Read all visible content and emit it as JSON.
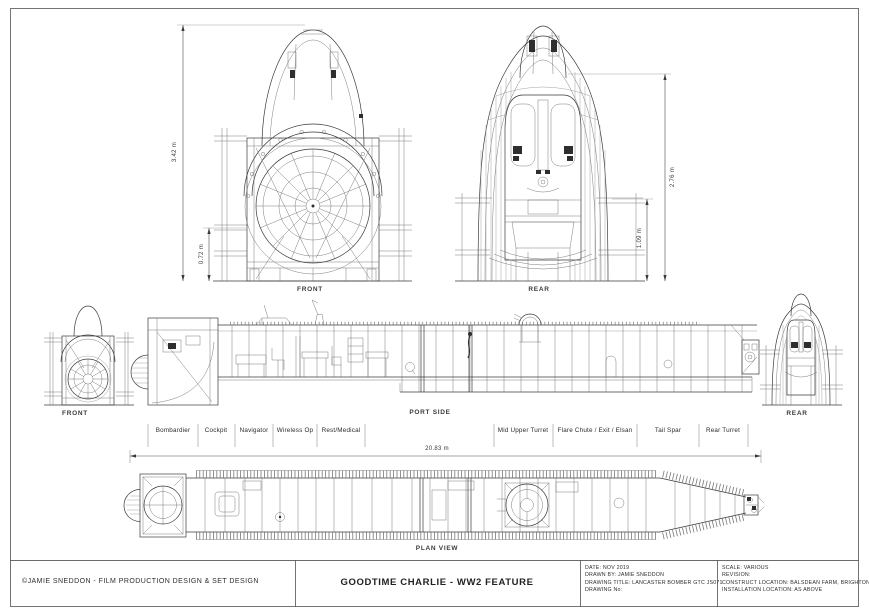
{
  "views": {
    "front_section_label": "FRONT",
    "rear_section_label": "REAR",
    "front_small_label": "FRONT",
    "port_side_label": "PORT SIDE",
    "rear_small_label": "REAR",
    "plan_label": "PLAN VIEW"
  },
  "dimensions": {
    "front_total_height": "3.42 m",
    "front_floor_height": "0.72 m",
    "rear_total_height": "2.76 m",
    "rear_floor_height": "1.09 m",
    "fuselage_length": "20.83 m"
  },
  "compartments": [
    "Bombardier",
    "Cockpit",
    "Navigator",
    "Wireless Op",
    "Rest/Medical",
    "Mid Upper Turret",
    "Flare Chute / Exit / Elsan",
    "Tail Spar",
    "Rear Turret"
  ],
  "title_block": {
    "copyright": "©JAMIE SNEDDON - FILM PRODUCTION DESIGN & SET DESIGN",
    "project_title": "GOODTIME CHARLIE - WW2 FEATURE",
    "info_left": [
      "DATE: NOV 2019",
      "DRAWN BY: JAMIE SNEDDON",
      "DRAWING TITLE: LANCASTER BOMBER GTC JS071",
      "DRAWING No:"
    ],
    "info_right": [
      "SCALE: VARIOUS",
      "REVISION:",
      "CONSTRUCT LOCATION: BALSDEAN FARM, BRIGHTON",
      "INSTALLATION LOCATION: AS ABOVE"
    ]
  },
  "colors": {
    "line": "#3a3a3a",
    "paper": "#ffffff"
  }
}
